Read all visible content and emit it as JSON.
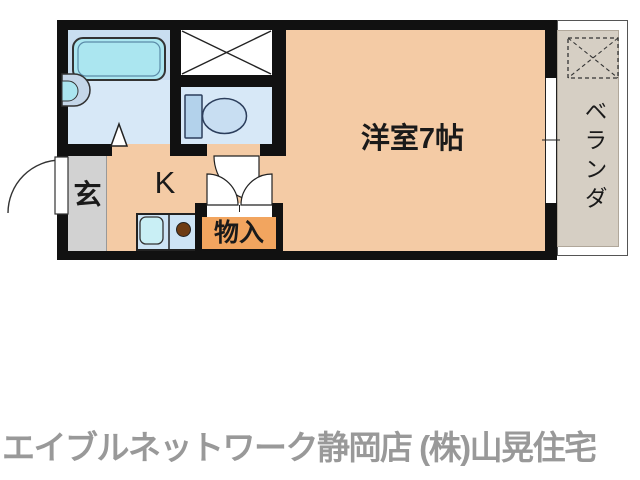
{
  "floor_plan": {
    "labels": {
      "entrance": "玄",
      "kitchen": "K",
      "storage": "物入",
      "main_room": "洋室7帖",
      "balcony": "ベランダ"
    },
    "colors": {
      "wall": "#111111",
      "room_fill": "#f4cba5",
      "wet_room_fill": "#d7e8f7",
      "bathtub": "#abe6f0",
      "storage_fill": "#f2a55f",
      "entrance_fill": "#d2d2d2",
      "balcony_fill": "#d6cfc4",
      "counter_fill": "#cde4f5",
      "burner": "#6e3c14",
      "footer_text": "#999999"
    },
    "icons": {
      "bathtub": "bathtub-icon",
      "washbasin": "washbasin-icon",
      "toilet": "toilet-icon",
      "washing_machine_space": "crossed-box-icon",
      "kitchen_sink": "kitchen-sink-icon",
      "stove_burner": "stove-burner-icon",
      "entrance_door": "door-swing-icon",
      "toilet_door": "door-swing-icon",
      "storage_doors": "bifold-door-icon",
      "bathroom_door": "folding-door-triangle-icon",
      "balcony_window": "sliding-window-icon",
      "outdoor_unit_space": "dashed-crossed-box-icon"
    }
  },
  "footer": {
    "company_text": "エイブルネットワーク静岡店 (株)山晃住宅"
  }
}
